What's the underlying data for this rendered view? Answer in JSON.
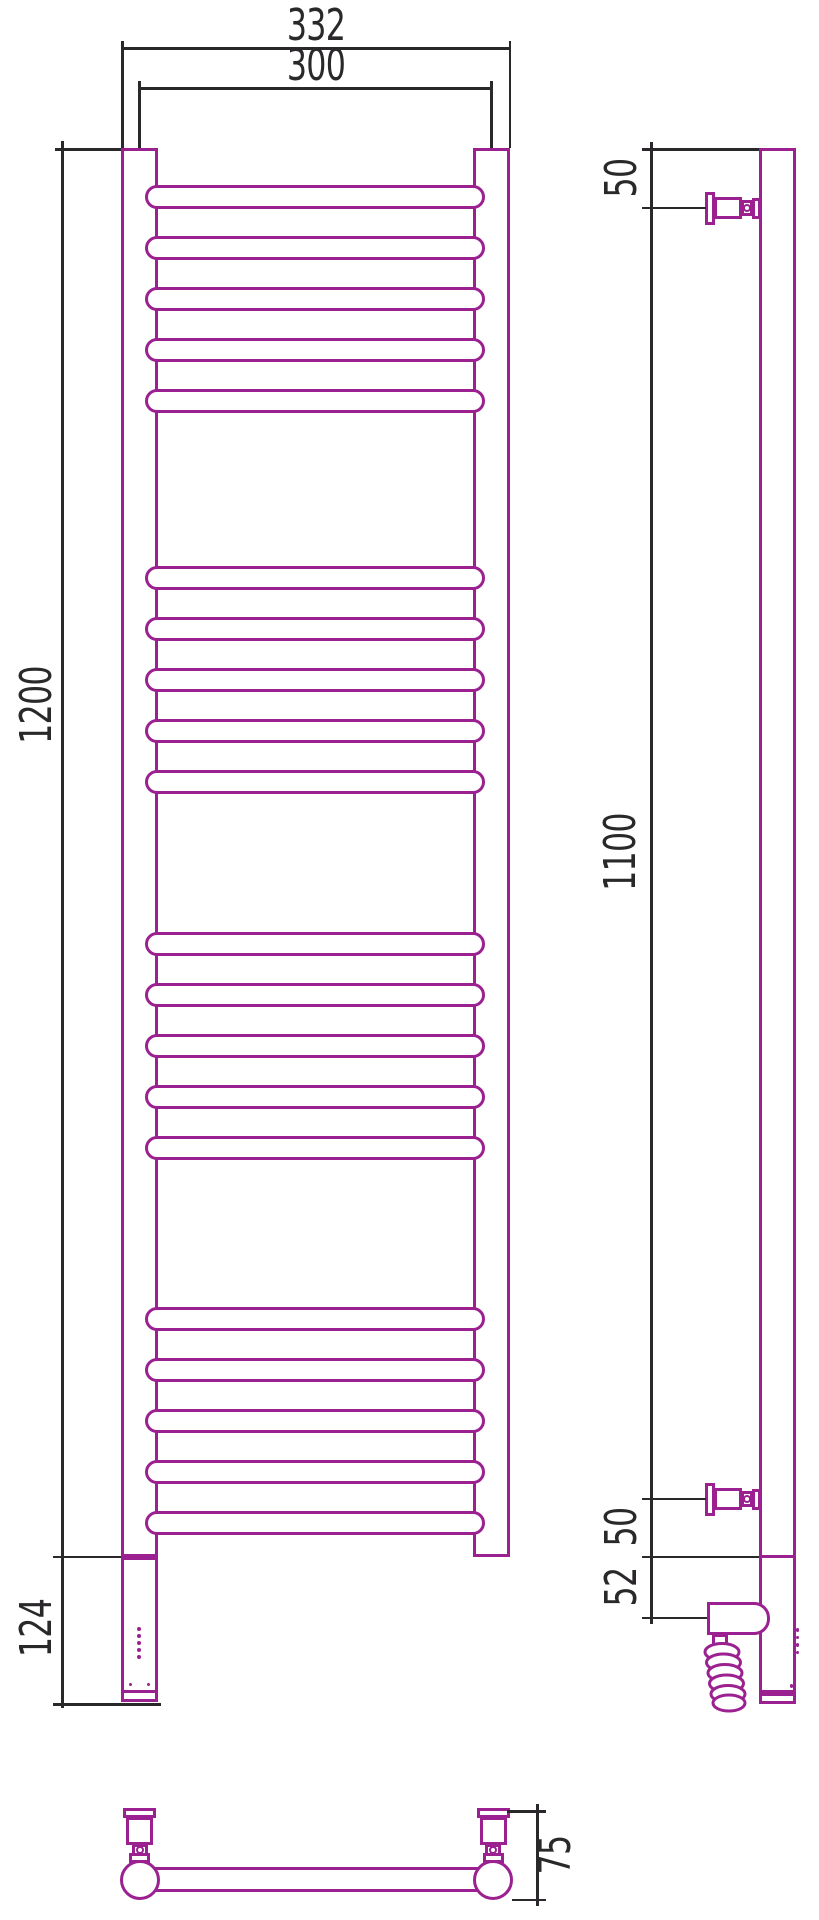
{
  "drawing": {
    "colors": {
      "outline": "#9B2191",
      "dimension_lines": "#2A282A",
      "background": "#FFFFFF"
    },
    "dimensions": {
      "overall_width": "332",
      "rail_center_spacing": "300",
      "body_height": "1200",
      "bottom_housing_height": "124",
      "side_top_bracket_offset": "50",
      "side_bracket_span": "1100",
      "side_bottom_bracket_offset": "50",
      "side_heater_offset": "52",
      "wall_depth": "75"
    },
    "rungs": {
      "groups": 4,
      "rungs_per_group": 5,
      "total": 20,
      "group_tops": [
        185,
        566,
        932,
        1307
      ],
      "pitch": 51,
      "height": 24
    }
  }
}
